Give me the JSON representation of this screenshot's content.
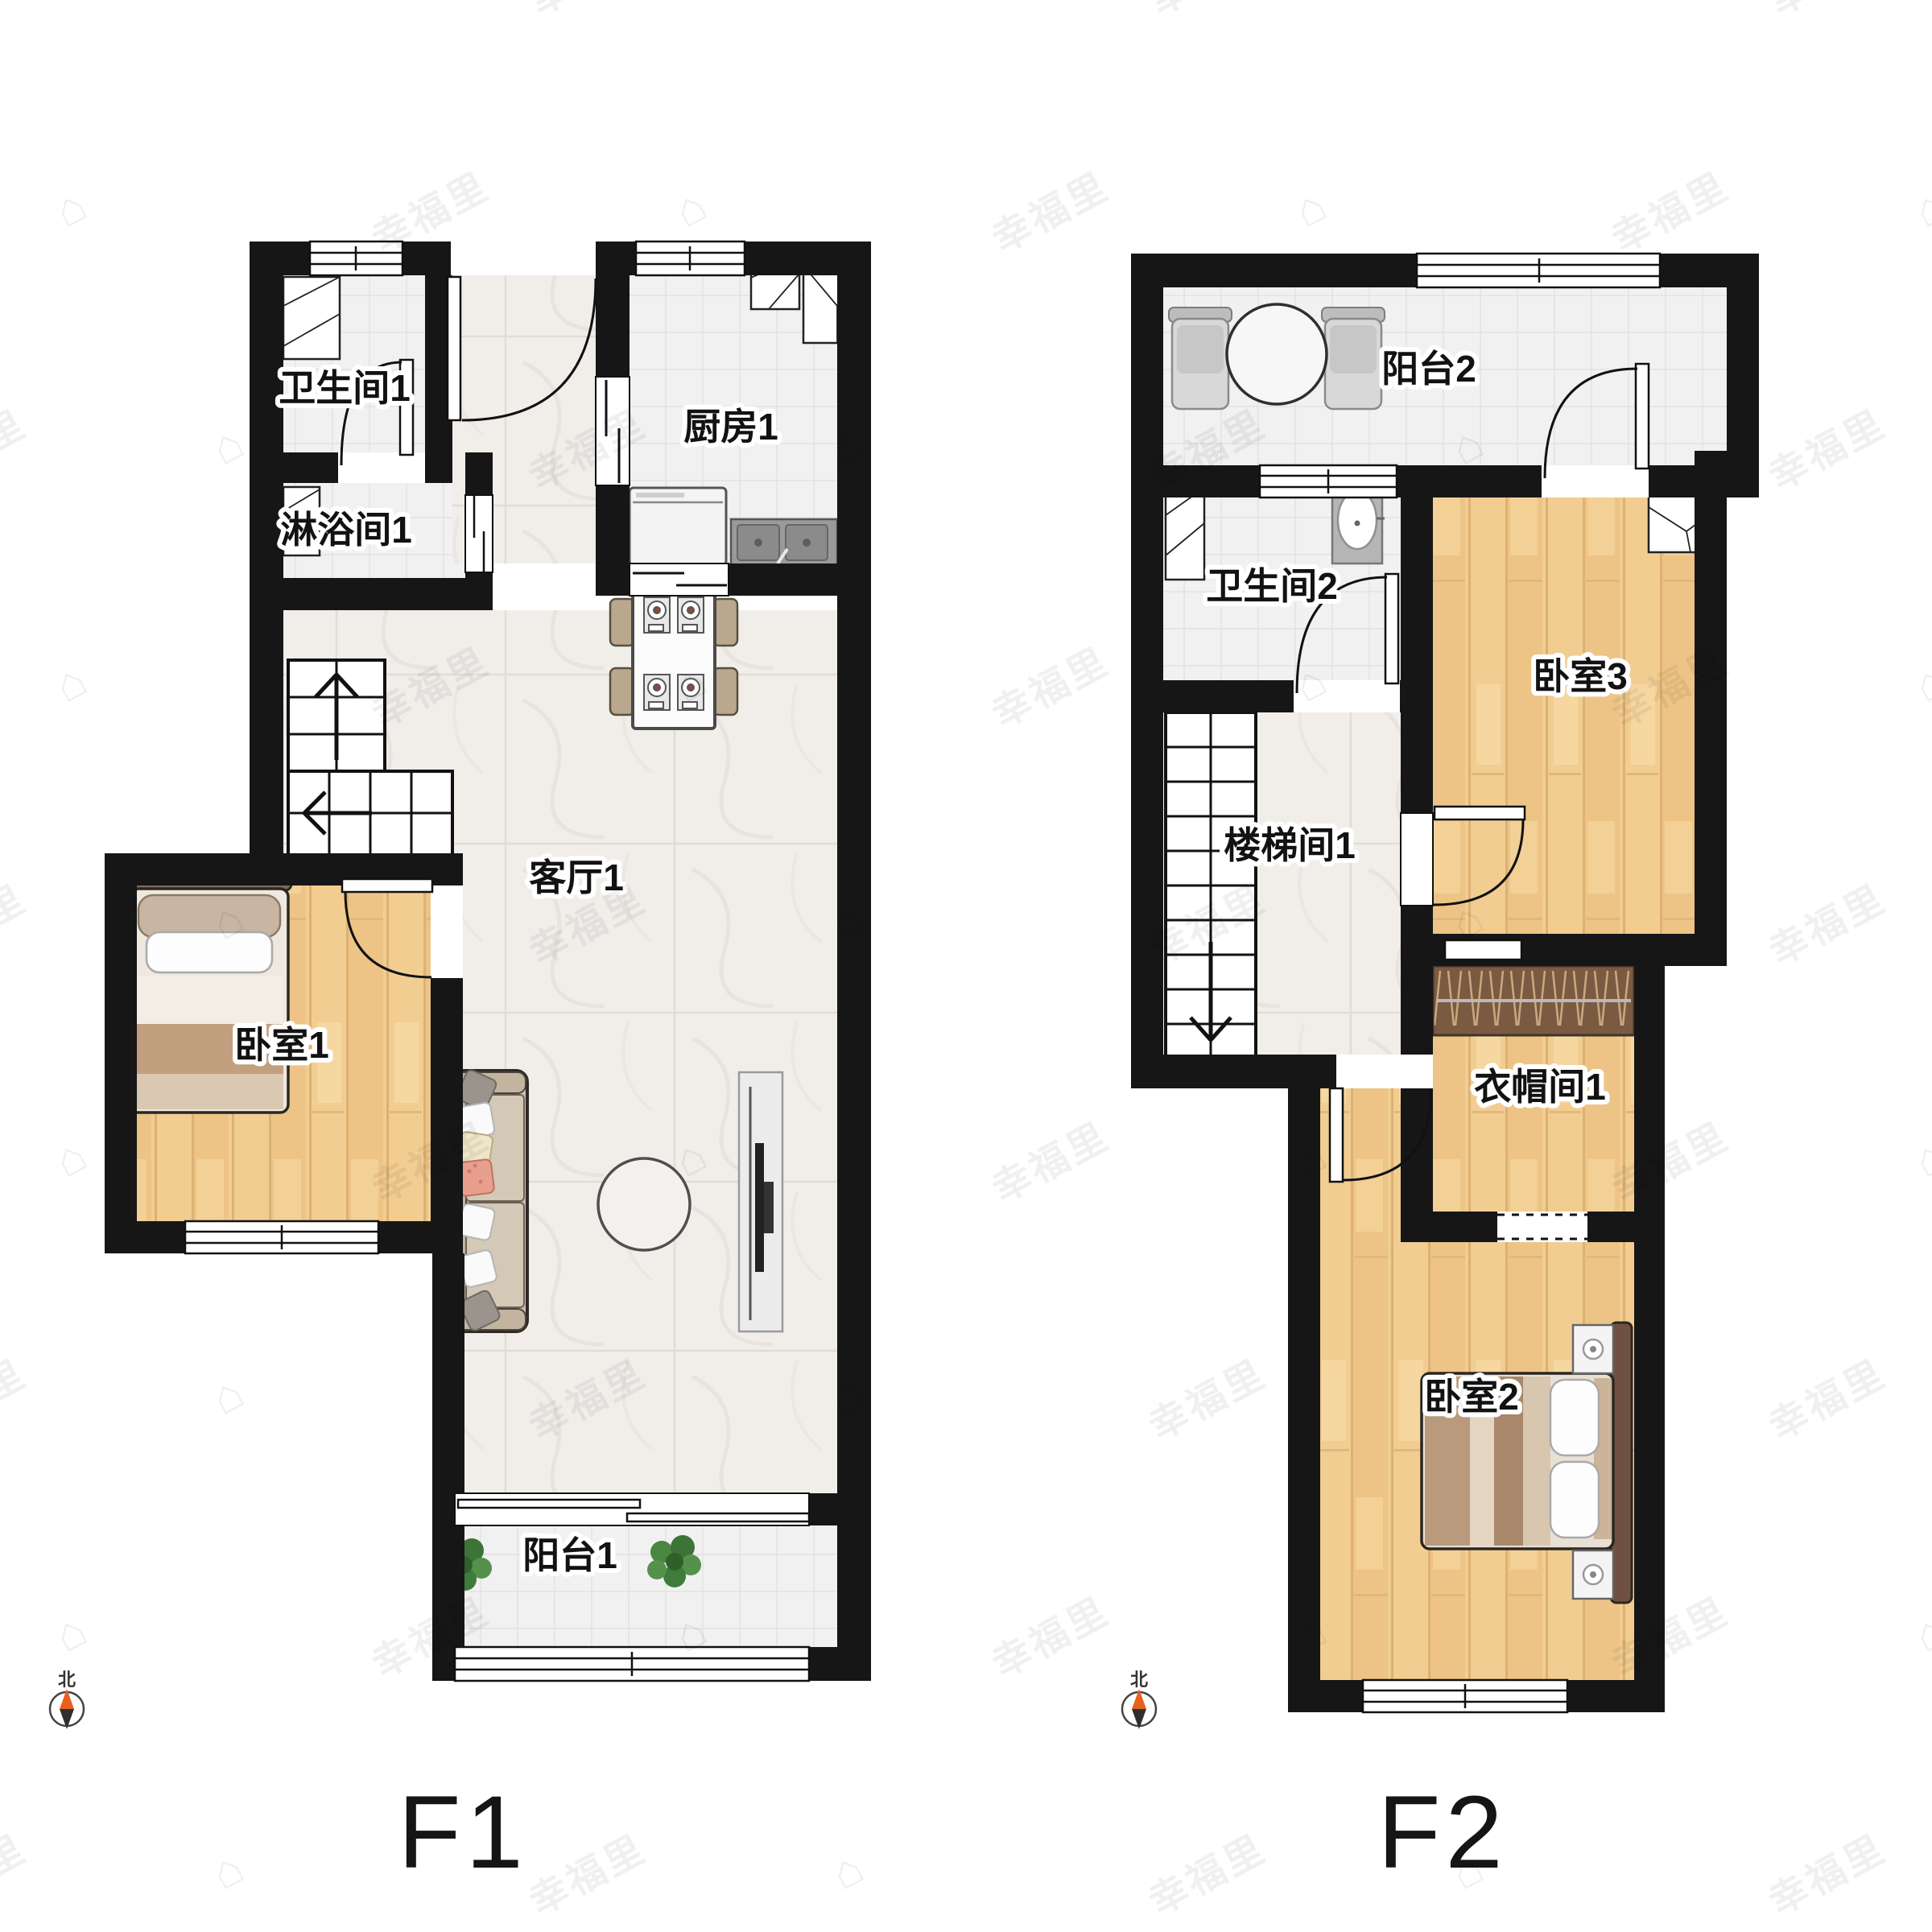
{
  "watermark": {
    "text": "幸福里",
    "house_icon": "⌂",
    "rows": 9,
    "cols": 7
  },
  "colors": {
    "wall": "#161616",
    "wood_floor": "#f2cd92",
    "marble_floor": "#f1eeea",
    "tile_floor": "#f1f1f1",
    "rack_brown": "#7b5a42",
    "compass_north_orange": "#e8611c"
  },
  "floors": [
    {
      "id": "F1",
      "title": "F1",
      "compass_label": "北",
      "rooms": [
        {
          "name": "bathroom-1",
          "label": "卫生间1"
        },
        {
          "name": "shower-1",
          "label": "淋浴间1"
        },
        {
          "name": "kitchen-1",
          "label": "厨房1"
        },
        {
          "name": "living-1",
          "label": "客厅1"
        },
        {
          "name": "bedroom-1",
          "label": "卧室1"
        },
        {
          "name": "balcony-1",
          "label": "阳台1"
        }
      ]
    },
    {
      "id": "F2",
      "title": "F2",
      "compass_label": "北",
      "rooms": [
        {
          "name": "balcony-2",
          "label": "阳台2"
        },
        {
          "name": "bathroom-2",
          "label": "卫生间2"
        },
        {
          "name": "bedroom-3",
          "label": "卧室3"
        },
        {
          "name": "stairwell-1",
          "label": "楼梯间1"
        },
        {
          "name": "cloakroom-1",
          "label": "衣帽间1"
        },
        {
          "name": "bedroom-2",
          "label": "卧室2"
        }
      ]
    }
  ]
}
